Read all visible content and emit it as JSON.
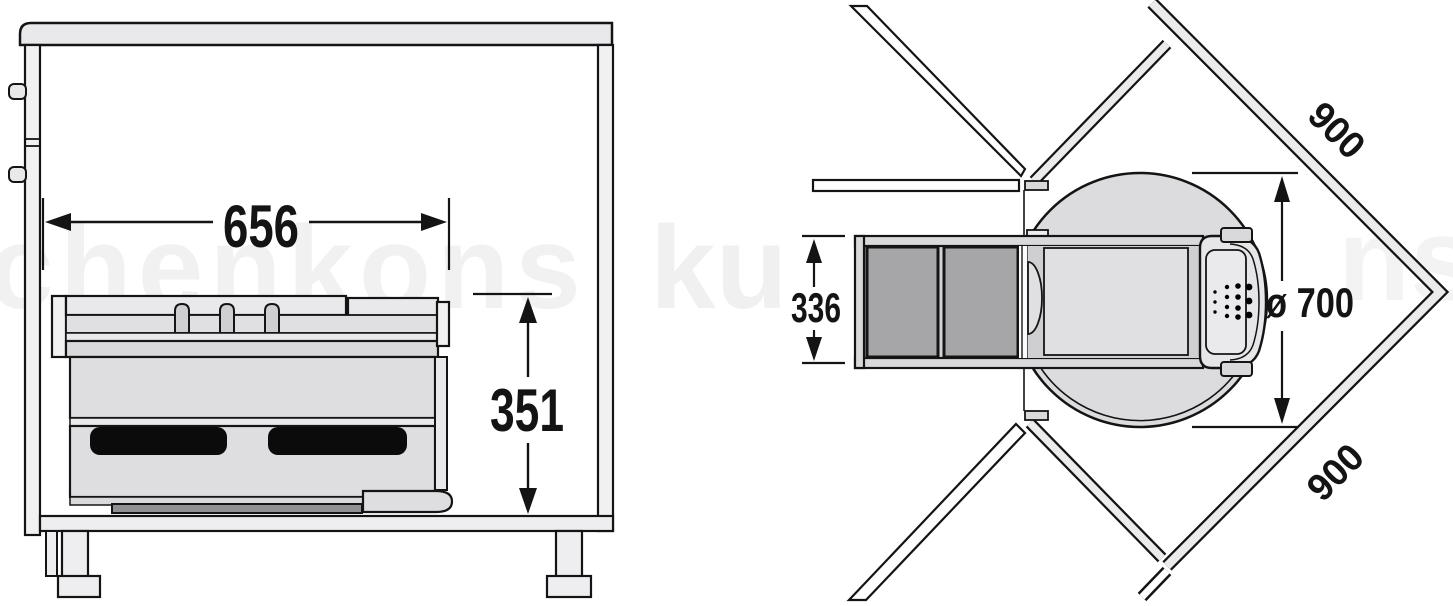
{
  "front_view": {
    "width_label": "656",
    "height_label": "351"
  },
  "top_view": {
    "depth_label": "336",
    "diameter_label": "ø 700",
    "run_label_top": "900",
    "run_label_bottom": "900"
  },
  "watermark": {
    "fragment_left": "chenkons",
    "fragment_mid": "ku",
    "fragment_right": "ns"
  },
  "colors": {
    "outline": "#141414",
    "counter_fill": "#e9e9eb",
    "panel_fill": "#f1f1f2",
    "floor_fill": "#eeeef0",
    "body_fill": "#dedee0",
    "rail_fill": "#d9d9db",
    "nub_fill": "#cfcfd1",
    "slot_black": "#0b0b0b",
    "dark_rail": "#909092",
    "bin_dark": "#a6a6a8",
    "carousel_fill": "#dcdcde",
    "tray_fill": "#cfcfd1",
    "tray_inner_fill": "#e0e0e2",
    "frame_interior": "#d3d3d5",
    "door_fill": "#e6e6e8",
    "wall_gray": "#ebebeb"
  }
}
